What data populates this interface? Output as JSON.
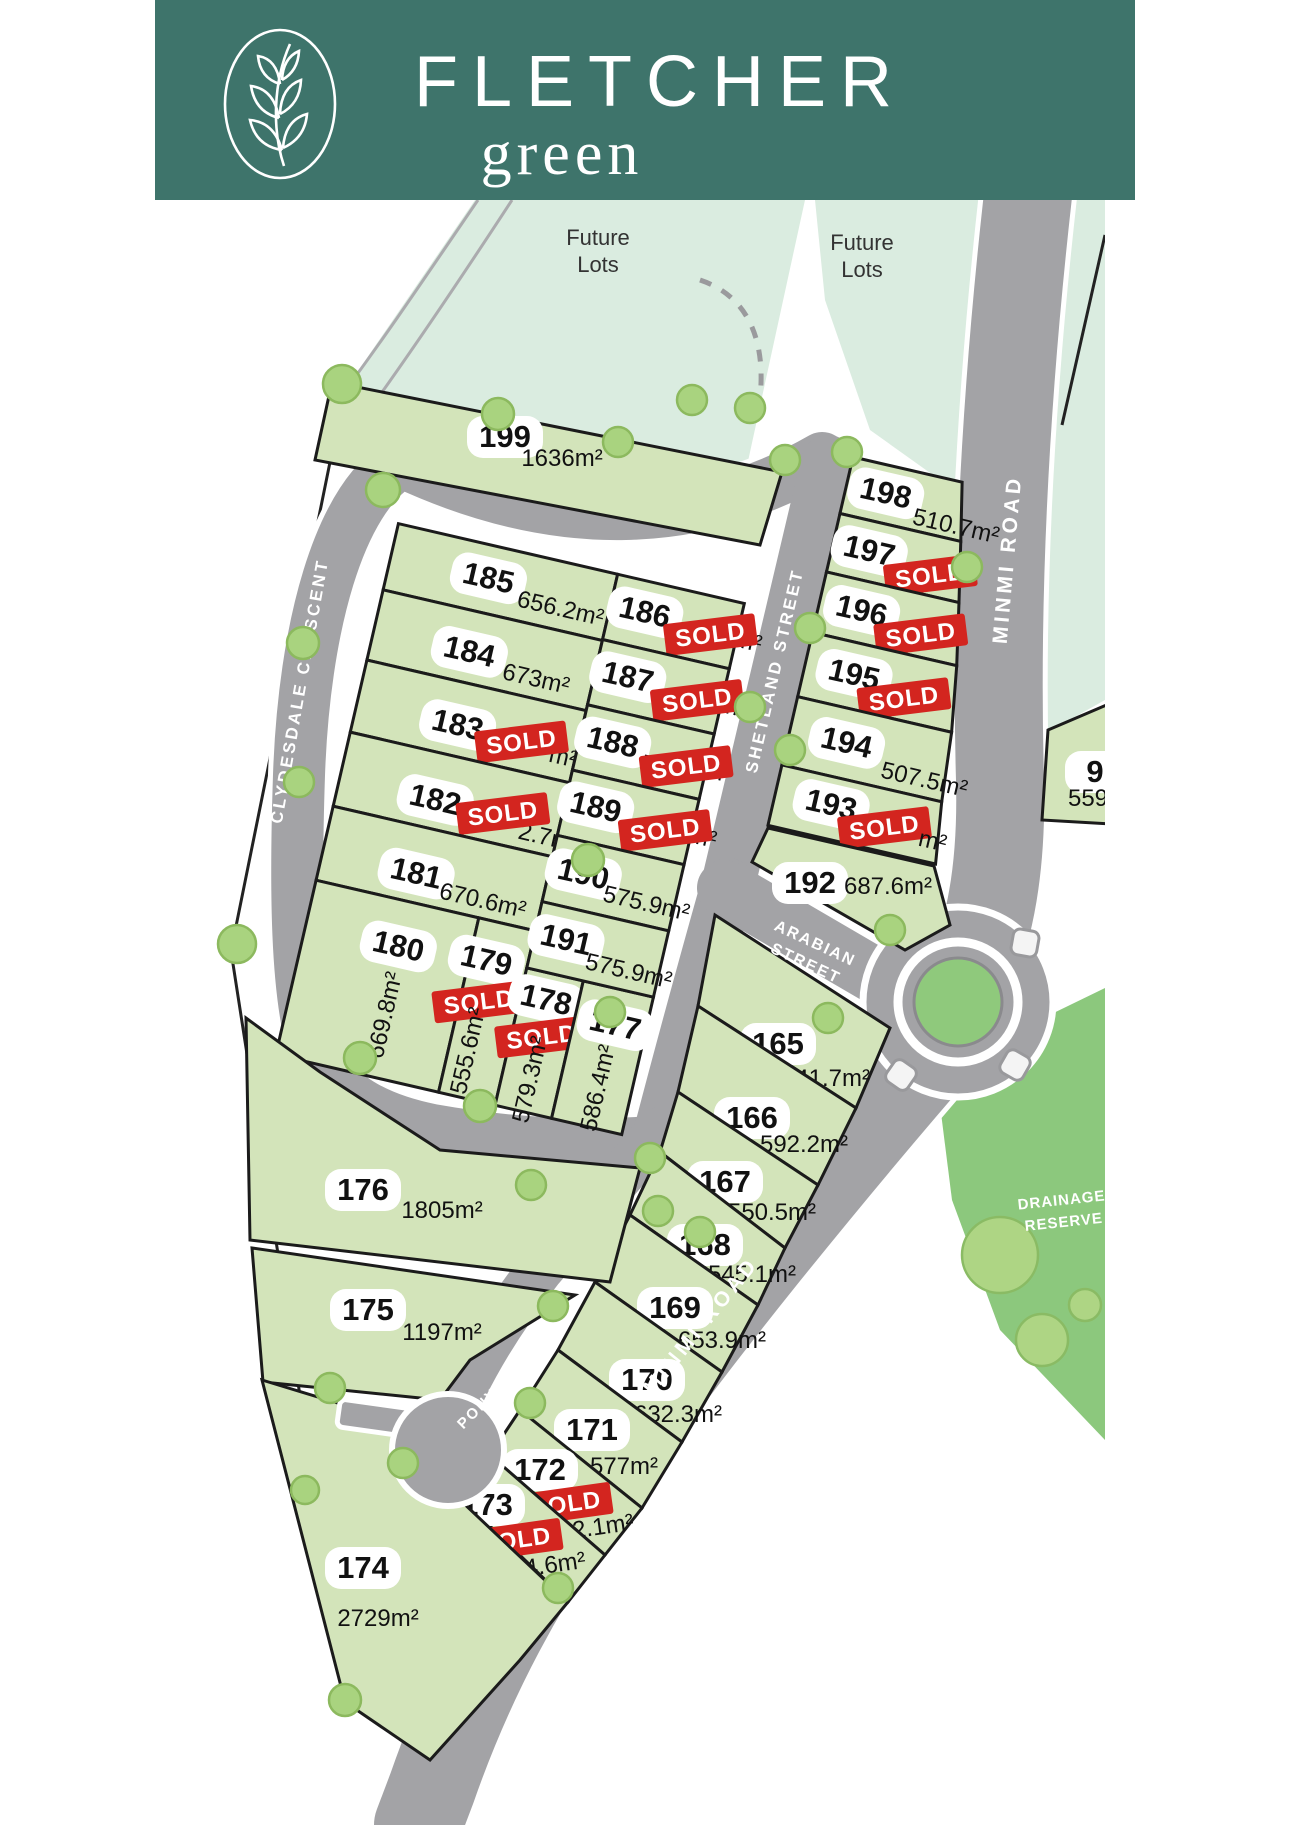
{
  "brand": {
    "title": "FLETCHER",
    "subtitle": "green"
  },
  "map": {
    "labels": {
      "future": "Future",
      "lots_word": "Lots"
    },
    "roads": {
      "clydesdale": "CLYDESDALE   CRESCENT",
      "shetland": "SHETLAND   STREET",
      "arabian_line1": "ARABIAN",
      "arabian_line2": "STREET",
      "minmi": "MINMI  ROAD",
      "pony": "PONY   CLOSE",
      "drainage_line1": "DRAINAGE",
      "drainage_line2": "RESERVE"
    },
    "badges": {
      "sold": "SOLD"
    },
    "colors": {
      "banner_teal": "#3E746B",
      "lot_green": "#D3E4BA",
      "future_mint": "#DAECE0",
      "road_grey": "#A3A3A6",
      "drainage_green": "#8CC87D",
      "sold_red": "#D3251F"
    }
  },
  "lots": {
    "199": {
      "number": "199",
      "area": "1636m²"
    },
    "198": {
      "number": "198",
      "area": "510.7m²"
    },
    "197": {
      "number": "197",
      "area_prefix": "5",
      "area_suffix": "",
      "sold": true
    },
    "196": {
      "number": "196",
      "area_prefix": "5",
      "area_suffix": "",
      "sold": true
    },
    "195": {
      "number": "195",
      "area_prefix": "5",
      "area_suffix": "",
      "sold": true
    },
    "194": {
      "number": "194",
      "area": "507.5m²"
    },
    "193": {
      "number": "193",
      "area_prefix": "",
      "area_suffix": "m²",
      "sold": true
    },
    "192": {
      "number": "192",
      "area": "687.6m²"
    },
    "185": {
      "number": "185",
      "area": "656.2m²"
    },
    "184": {
      "number": "184",
      "area": "673m²"
    },
    "183": {
      "number": "183",
      "area_prefix": "6",
      "area_suffix": "m²",
      "sold": true
    },
    "182": {
      "number": "182",
      "area_prefix": "6",
      "area_suffix": "2.7m²",
      "sold": true
    },
    "181": {
      "number": "181",
      "area": "670.6m²"
    },
    "180": {
      "number": "180",
      "area": "669.8m²"
    },
    "179": {
      "number": "179",
      "area": "555.6m²",
      "sold": true
    },
    "178": {
      "number": "178",
      "area": "579.3m²",
      "sold": true
    },
    "177": {
      "number": "177",
      "area": "586.4m²"
    },
    "186": {
      "number": "186",
      "area_prefix": "5",
      "area_suffix": "m²",
      "sold": true
    },
    "187": {
      "number": "187",
      "area_prefix": "5",
      "area_suffix": "m²",
      "sold": true
    },
    "188": {
      "number": "188",
      "area_prefix": "5",
      "area_suffix": "m²",
      "sold": true
    },
    "189": {
      "number": "189",
      "area_prefix": "5",
      "area_suffix": "m²",
      "sold": true
    },
    "190": {
      "number": "190",
      "area": "575.9m²"
    },
    "191": {
      "number": "191",
      "area": "575.9m²"
    },
    "165": {
      "number": "165",
      "area": "641.7m²"
    },
    "166": {
      "number": "166",
      "area": "592.2m²"
    },
    "167": {
      "number": "167",
      "area": "550.5m²"
    },
    "168": {
      "number": "168",
      "area": "545.1m²"
    },
    "169": {
      "number": "169",
      "area": "653.9m²"
    },
    "170": {
      "number": "170",
      "area": "632.3m²"
    },
    "171": {
      "number": "171",
      "area": "577m²"
    },
    "172": {
      "number": "172",
      "area_prefix": "",
      "area_suffix": "2.1m²",
      "sold": true
    },
    "173": {
      "number": "173",
      "area_prefix": "",
      "area_suffix": "4.6m²",
      "sold": true
    },
    "174": {
      "number": "174",
      "area": "2729m²"
    },
    "175": {
      "number": "175",
      "area": "1197m²"
    },
    "176": {
      "number": "176",
      "area": "1805m²"
    },
    "lot9": {
      "number": "9",
      "area": "559"
    }
  }
}
